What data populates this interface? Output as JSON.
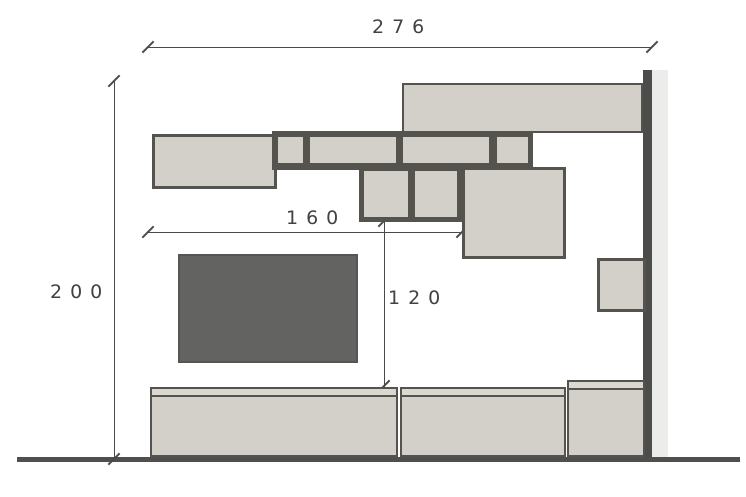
{
  "drawing": {
    "type": "wall-unit-elevation",
    "dim_labels": {
      "total_width": "276",
      "total_height": "200",
      "inner_width": "160",
      "inner_height": "120"
    }
  },
  "colors": {
    "bg": "#ffffff",
    "panel-fill": "#d3d0c9",
    "panel-lid": "#dbd8d1",
    "outline": "#54534e",
    "tv-fill": "#636362",
    "tv-border": "#555554",
    "wall-dark": "#4c4c4b",
    "wall-light": "#ececeb",
    "floor": "#4f4f4e",
    "dim-line": "#4a4a49",
    "label": "#424241"
  }
}
